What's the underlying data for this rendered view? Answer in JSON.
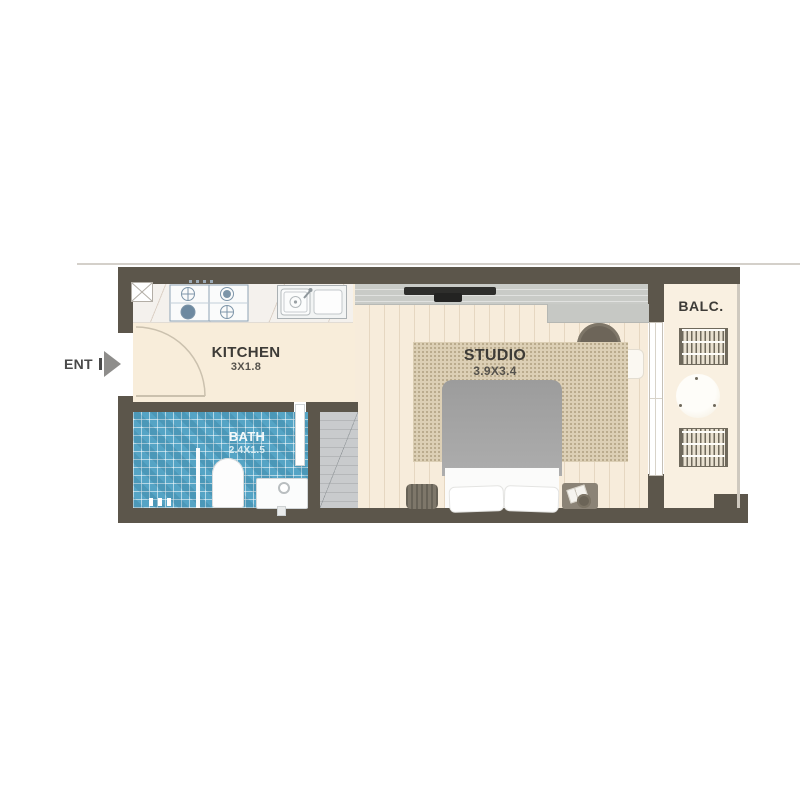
{
  "plan": {
    "type": "studio-apartment-floor-plan",
    "entrance_label": "ENT",
    "rooms": {
      "kitchen": {
        "label": "KITCHEN",
        "dims": "3X1.8"
      },
      "bath": {
        "label": "BATH",
        "dims": "2.4X1.5"
      },
      "studio": {
        "label": "STUDIO",
        "dims": "3.9X3.4"
      },
      "balcony": {
        "label": "BALC."
      }
    },
    "fixtures": [
      "gas-stove",
      "kitchen-sink",
      "service-shaft",
      "entry-door-swing",
      "toilet",
      "bathroom-sink",
      "shower-screen",
      "wardrobe",
      "tv",
      "media-console",
      "desk",
      "desk-chair",
      "side-table",
      "rug",
      "double-bed",
      "pillows",
      "nightstand-left",
      "nightstand-right",
      "sliding-glass-door",
      "balcony-chair-top",
      "balcony-chair-bottom",
      "balcony-table",
      "balcony-railing"
    ],
    "colors": {
      "wall": "#5c564b",
      "floor": "#f7ecdb",
      "bath_tile": "#55a4c5",
      "rug": "#dccfb5",
      "bed_duvet": "#a7a7a7",
      "console": "#c9cbc7",
      "label_text": "#3d3b37",
      "bath_label_text": "#f3f9fa"
    }
  }
}
